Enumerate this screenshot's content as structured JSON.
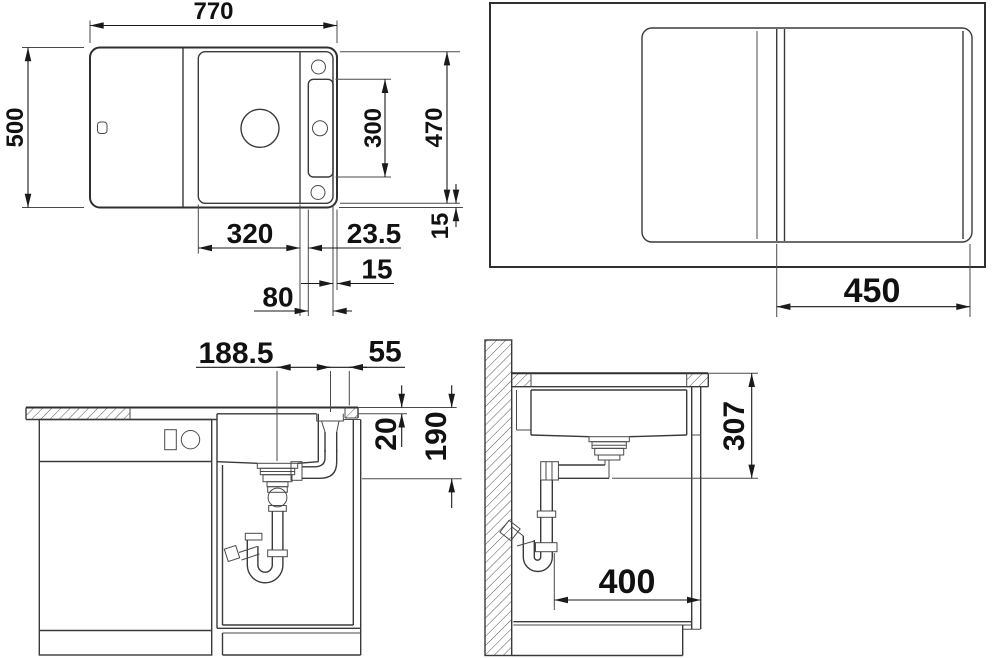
{
  "drawing": {
    "ink_color": "#1a1a1a",
    "line_color": "#3a3a3a",
    "views": {
      "plan": {
        "name": "sink-plan-view",
        "dims": {
          "overall_width": "770",
          "overall_depth": "500",
          "cutout_depth": "470",
          "deck_length": "300",
          "edge_margin": "15",
          "bowl_width": "320",
          "bowl_to_deck_gap": "23.5",
          "deck_to_edge": "15",
          "deck_width": "80"
        }
      },
      "plan_board": {
        "name": "plan-view-with-cutting-board",
        "dims": {
          "board_width": "450"
        }
      },
      "front": {
        "name": "front-section-view",
        "dims": {
          "drain_to_hole": "188.5",
          "hole_to_edge": "55",
          "rim_height": "20",
          "drain_height": "190"
        }
      },
      "side": {
        "name": "side-section-view",
        "dims": {
          "top_to_drain": "307",
          "wall_to_front": "400"
        }
      }
    }
  }
}
